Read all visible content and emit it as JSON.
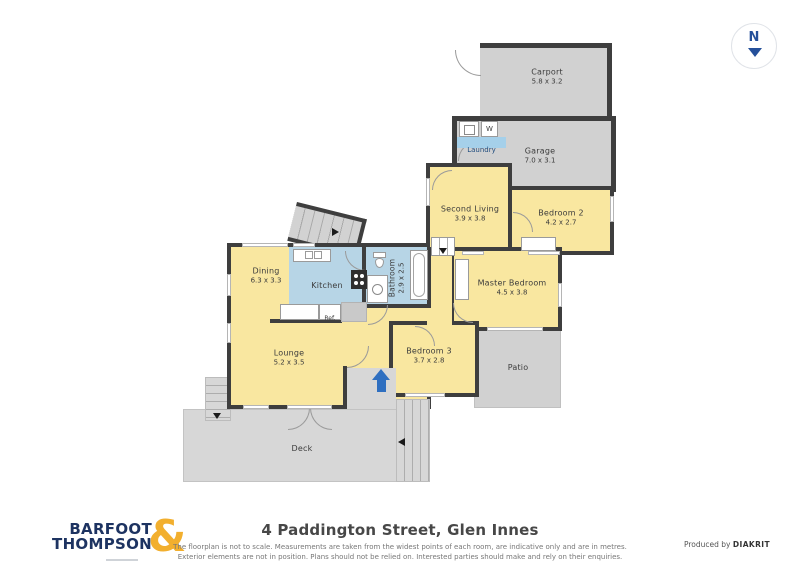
{
  "compass": {
    "label": "N"
  },
  "rooms": {
    "carport": {
      "name": "Carport",
      "dims": "5.8 x 3.2"
    },
    "garage": {
      "name": "Garage",
      "dims": "7.0 x 3.1"
    },
    "laundry": {
      "name": "Laundry"
    },
    "second_living": {
      "name": "Second Living",
      "dims": "3.9 x 3.8"
    },
    "bedroom2": {
      "name": "Bedroom 2",
      "dims": "4.2 x 2.7"
    },
    "master_bedroom": {
      "name": "Master Bedroom",
      "dims": "4.5 x 3.8"
    },
    "bedroom3": {
      "name": "Bedroom 3",
      "dims": "3.7 x 2.8"
    },
    "patio": {
      "name": "Patio"
    },
    "dining": {
      "name": "Dining",
      "dims": "6.3 x 3.3"
    },
    "kitchen": {
      "name": "Kitchen"
    },
    "bathroom": {
      "name": "Bathroom",
      "dims": "2.9 x 2.5"
    },
    "lounge": {
      "name": "Lounge",
      "dims": "5.2 x 3.5"
    },
    "deck": {
      "name": "Deck"
    }
  },
  "fixtures": {
    "washer_label": "W",
    "fridge_label": "Ref."
  },
  "branding": {
    "logo_line1": "BARFOOT",
    "logo_line2": "THOMPSON",
    "logo_ampersand": "&"
  },
  "footer": {
    "address": "4 Paddington Street, Glen Innes",
    "disclaimer_line1": "The floorplan is not to scale. Measurements are taken from the widest points of each room, are indicative only and are in metres.",
    "disclaimer_line2": "Exterior elements are not in position. Plans should not be relied on. Interested parties should make and rely on their enquiries.",
    "produced_by": "Produced by",
    "producer": "DIAKRIT"
  },
  "colors": {
    "wall": "#3E3E3E",
    "room_yellow": "#F9E7A0",
    "room_blue": "#B7D5E6",
    "outdoor_gray": "#D1D1D1",
    "entrance_arrow_blue": "#2F6FC0",
    "logo_navy": "#1D3361",
    "logo_gold": "#F2AF2E",
    "compass_navy": "#25509A"
  }
}
